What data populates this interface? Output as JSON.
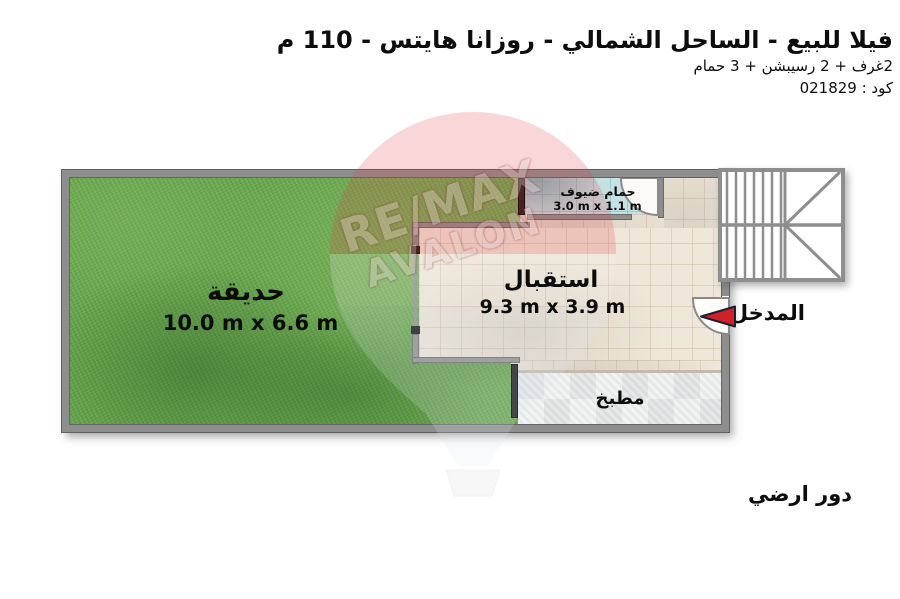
{
  "header": {
    "title": "فيلا للبيع - الساحل الشمالي - روزانا هايتس - 110 م",
    "subtitle": "2غرف + 2 رسيبشن + 3 حمام",
    "code": "كود : 021829"
  },
  "floor_label": "دور ارضي",
  "watermark": {
    "line1": "RE/MAX",
    "line2": "AVALON"
  },
  "plan": {
    "garden": {
      "name": "حديقة",
      "dimensions": "10.0 m x 6.6 m"
    },
    "reception": {
      "name": "استقبال",
      "dimensions": "9.3 m x 3.9 m"
    },
    "guest_bathroom": {
      "name": "حمام ضيوف",
      "dimensions": "3.0 m x 1.1 m"
    },
    "kitchen": {
      "name": "مطبخ"
    },
    "entrance": {
      "name": "المدخل"
    }
  },
  "colors": {
    "arrow_red": "#cf2128",
    "garden_green": "#69a84f",
    "bathroom_blue": "#c4e1e3",
    "floor_beige": "#efe7d9",
    "kitchen_gray": "#e9eaea",
    "wall_gray": "#8e8e8e",
    "watermark_red": "#e23c41"
  }
}
